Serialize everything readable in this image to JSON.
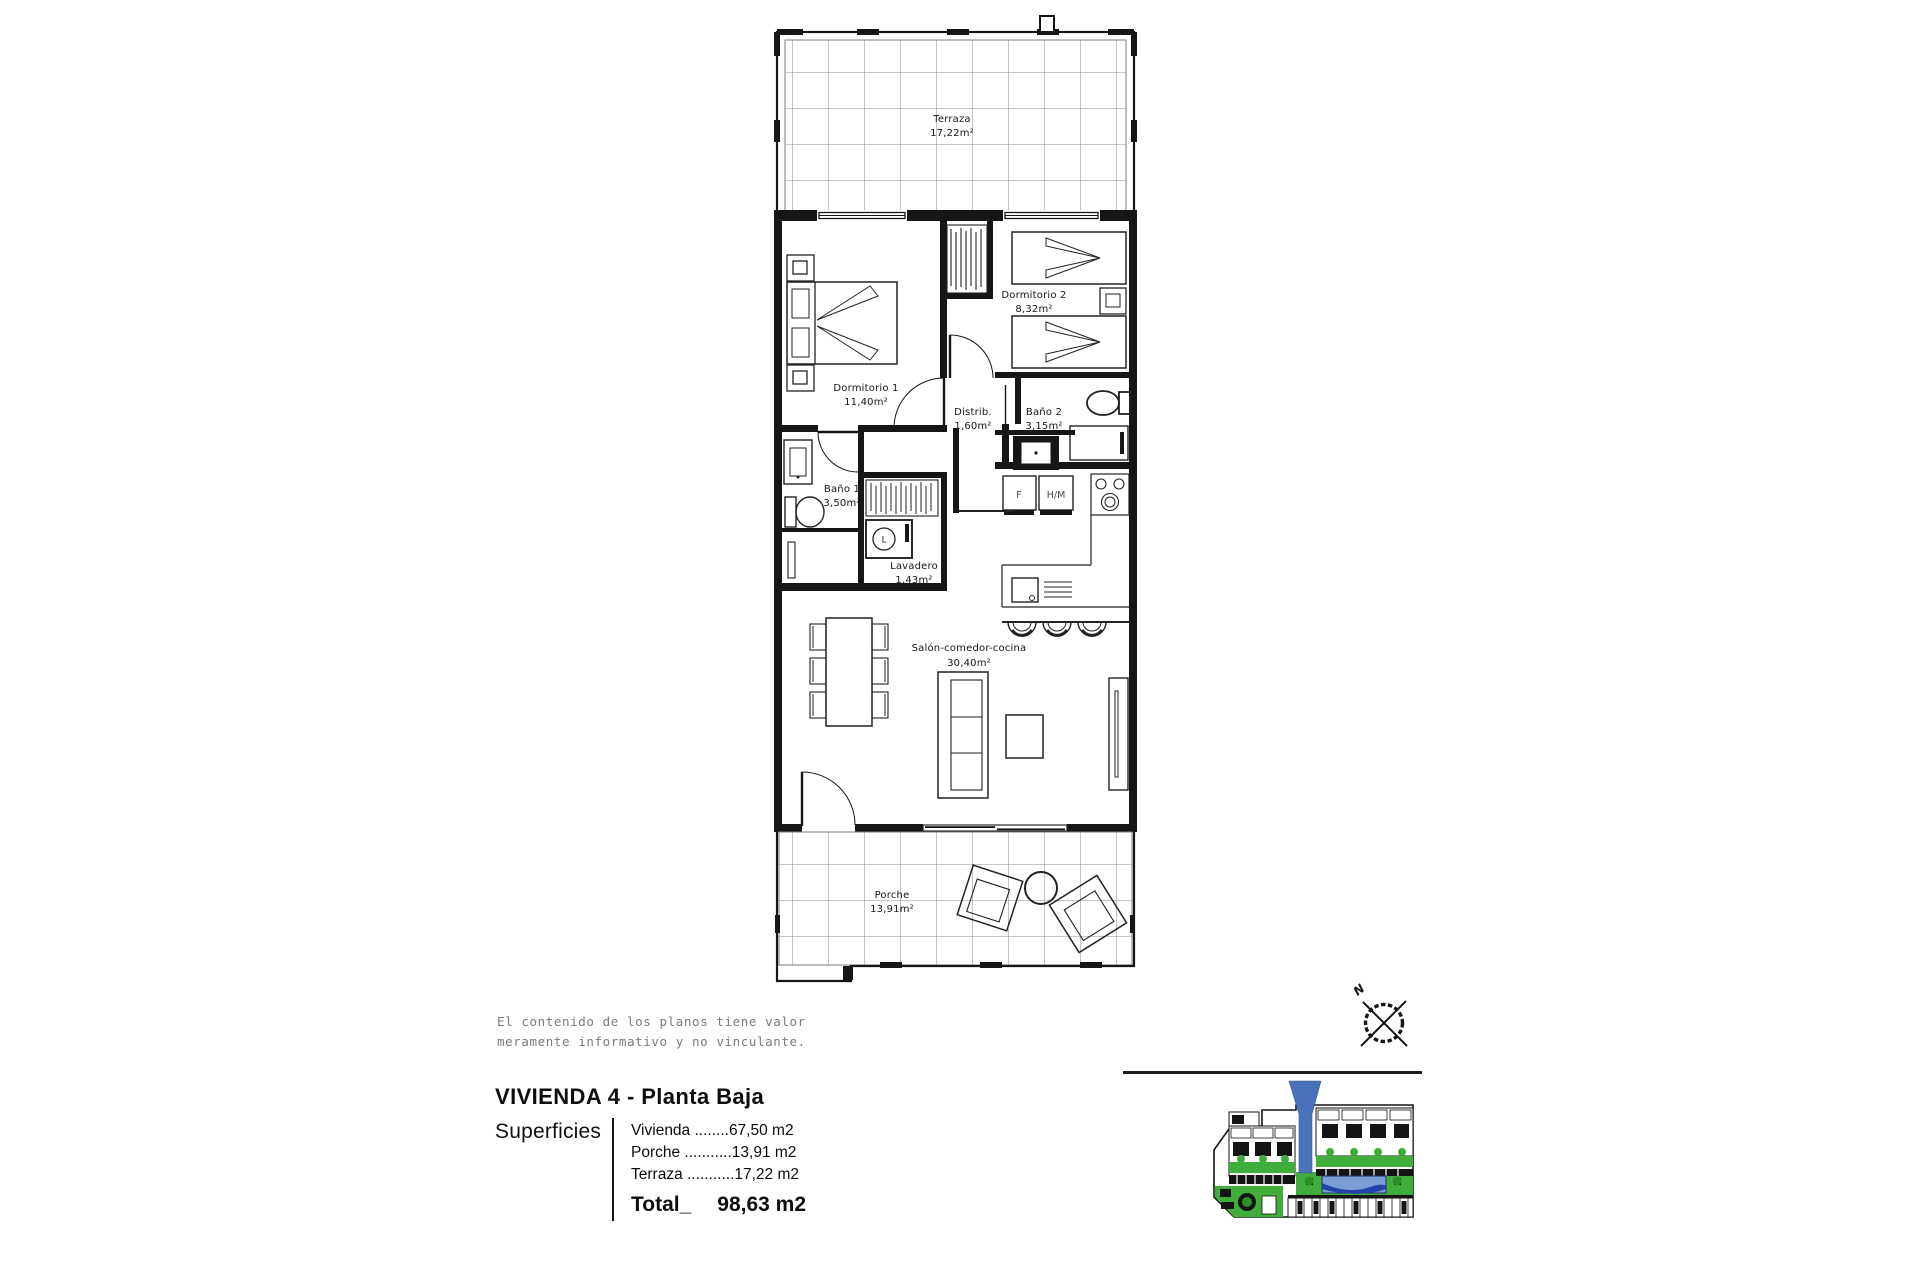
{
  "plan": {
    "rooms": [
      {
        "id": "terraza",
        "name": "Terraza",
        "area": "17,22m²"
      },
      {
        "id": "dormitorio1",
        "name": "Dormitorio 1",
        "area": "11,40m²"
      },
      {
        "id": "dormitorio2",
        "name": "Dormitorio 2",
        "area": "8,32m²"
      },
      {
        "id": "distrib",
        "name": "Distrib.",
        "area": "1,60m²"
      },
      {
        "id": "bano2",
        "name": "Baño 2",
        "area": "3,15m²"
      },
      {
        "id": "bano1",
        "name": "Baño 1",
        "area": "3,50m²"
      },
      {
        "id": "lavadero",
        "name": "Lavadero",
        "area": "1,43m²"
      },
      {
        "id": "salon",
        "name": "Salón-comedor-cocina",
        "area": "30,40m²"
      },
      {
        "id": "porche",
        "name": "Porche",
        "area": "13,91m²"
      }
    ],
    "appliances": {
      "fridge": "F",
      "oven_micro": "H/M",
      "washer": "L"
    }
  },
  "disclaimer": {
    "line1": "El contenido de los planos tiene valor",
    "line2": "meramente informativo y no vinculante."
  },
  "title_block": {
    "title": "VIVIENDA 4 - Planta Baja",
    "surfaces_label": "Superficies",
    "rows": [
      {
        "label": "Vivienda ",
        "dots": "........",
        "value": "67,50 m2"
      },
      {
        "label": "Porche ",
        "dots": "...........",
        "value": "13,91 m2"
      },
      {
        "label": "Terraza ",
        "dots": "...........",
        "value": "17,22 m2"
      }
    ],
    "total_label": "Total_",
    "total_value": "98,63 m2"
  },
  "compass": {
    "north_label": "N"
  },
  "site_plan": {
    "marker": "#4a72b8",
    "green": "#3fae3a",
    "green_dark": "#2e8f2c",
    "pool": "#7b9cd4",
    "pool_dark": "#2343a8"
  }
}
